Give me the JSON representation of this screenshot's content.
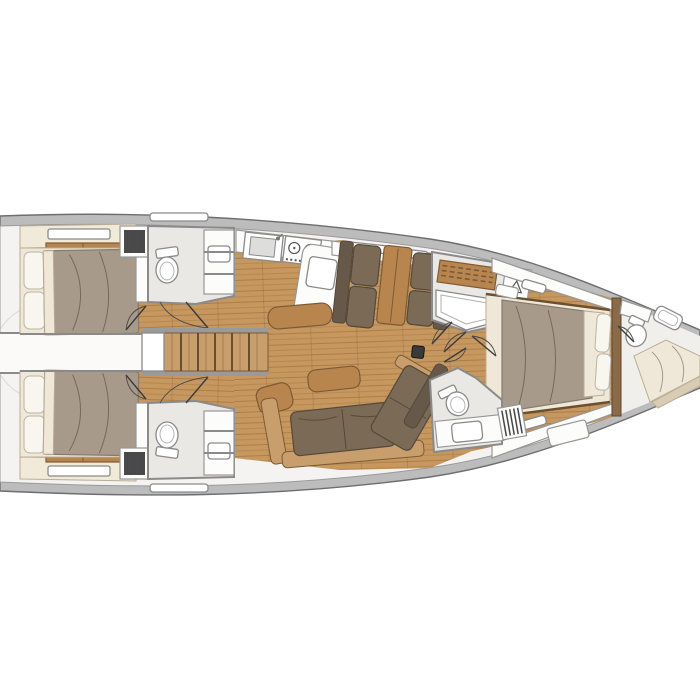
{
  "figure": {
    "kind": "floor-plan",
    "subject": "sailing-yacht-interior-layout",
    "orientation": "bow-right-stern-left",
    "text_labels": []
  },
  "palette": {
    "page_bg": "#ffffff",
    "hull_band": "#bcbcbc",
    "hull_line": "#6e6e6e",
    "interior": "#f4f3f1",
    "floor_wood": "#c6975f",
    "furniture_wood": "#b9854f",
    "furniture_wood_dark": "#7d5a33",
    "upholstery_brown": "#7b6a56",
    "upholstery_brown_dark": "#54483a",
    "duvet_taupe": "#a89a8b",
    "duvet_line": "#857a6c",
    "linen_cream": "#efe8d8",
    "cabinet_cream": "#f1ead9",
    "white_fixture": "#fcfcfb",
    "bath_floor": "#e9e8e4",
    "wall_line": "#8a8a8a",
    "door_line": "#3a3a3a",
    "mast_dark": "#3a3a3a",
    "sketch_line": "#c9c9c9"
  },
  "icons": [
    "toilet-icon",
    "sink-icon",
    "stove-burner-icon",
    "hanger-icon",
    "shower-grate-icon",
    "vent-grille-icon",
    "door-swing-arc",
    "stairs-icon",
    "mast-post-icon",
    "window-hatch-icon",
    "swim-ladder-sketch"
  ],
  "regions": [
    "aft-cabin-port",
    "aft-head-port",
    "aft-cabin-starboard",
    "aft-head-starboard",
    "stern-corridor",
    "companionway-stairs",
    "galley",
    "dinette",
    "shower-room",
    "hanging-locker",
    "salon",
    "owner-cabin",
    "forward-head",
    "bow-compartment"
  ]
}
